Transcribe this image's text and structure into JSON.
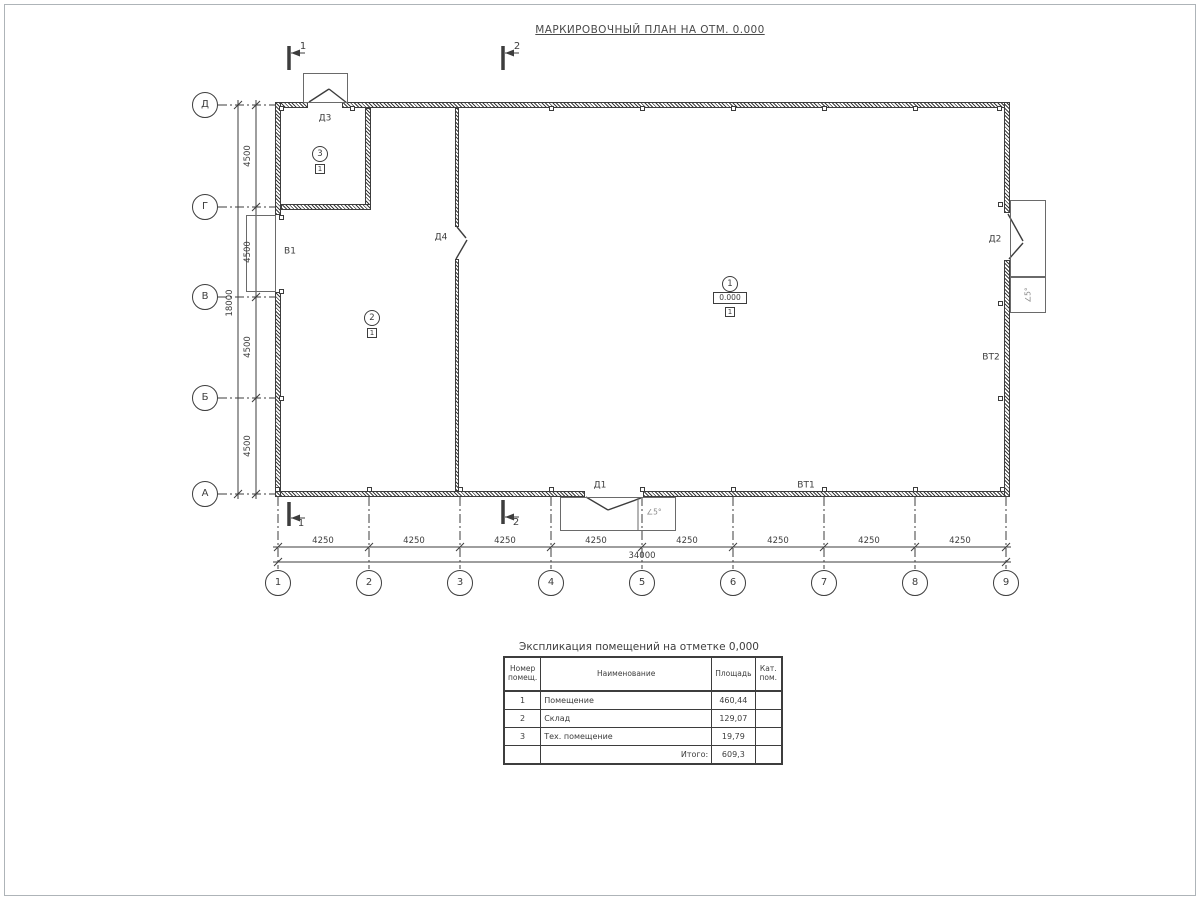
{
  "title": "МАРКИРОВОЧНЫЙ ПЛАН НА ОТМ. 0.000",
  "sections": {
    "s1": "1",
    "s2": "2"
  },
  "axes": {
    "rows": [
      "Д",
      "Г",
      "В",
      "Б",
      "А"
    ],
    "cols": [
      "1",
      "2",
      "3",
      "4",
      "5",
      "6",
      "7",
      "8",
      "9"
    ]
  },
  "dims": {
    "row_spacing": [
      "4500",
      "4500",
      "4500",
      "4500"
    ],
    "row_total": "18000",
    "col_spacing": [
      "4250",
      "4250",
      "4250",
      "4250",
      "4250",
      "4250",
      "4250",
      "4250"
    ],
    "col_total": "34000"
  },
  "rooms": [
    {
      "number": "1",
      "elevation": "0.000",
      "floor_type": "1"
    },
    {
      "number": "2",
      "floor_type": "1"
    },
    {
      "number": "3",
      "floor_type": "1"
    }
  ],
  "openings": {
    "d1": "Д1",
    "d2": "Д2",
    "d3": "Д3",
    "d4": "Д4",
    "v1": "В1",
    "vt1": "ВТ1",
    "vt2": "ВТ2"
  },
  "annotations": {
    "slope": "∠5°"
  },
  "explication": {
    "title": "Экспликация помещений на отметке 0,000",
    "headers": {
      "number": "Номер помещ.",
      "name": "Наименование",
      "area": "Площадь",
      "category": "Кат. пом."
    },
    "rows": [
      {
        "number": "1",
        "name": "Помещение",
        "area": "460,44",
        "category": ""
      },
      {
        "number": "2",
        "name": "Склад",
        "area": "129,07",
        "category": ""
      },
      {
        "number": "3",
        "name": "Тех. помещение",
        "area": "19,79",
        "category": ""
      }
    ],
    "total_label": "Итого:",
    "total_area": "609,3"
  }
}
